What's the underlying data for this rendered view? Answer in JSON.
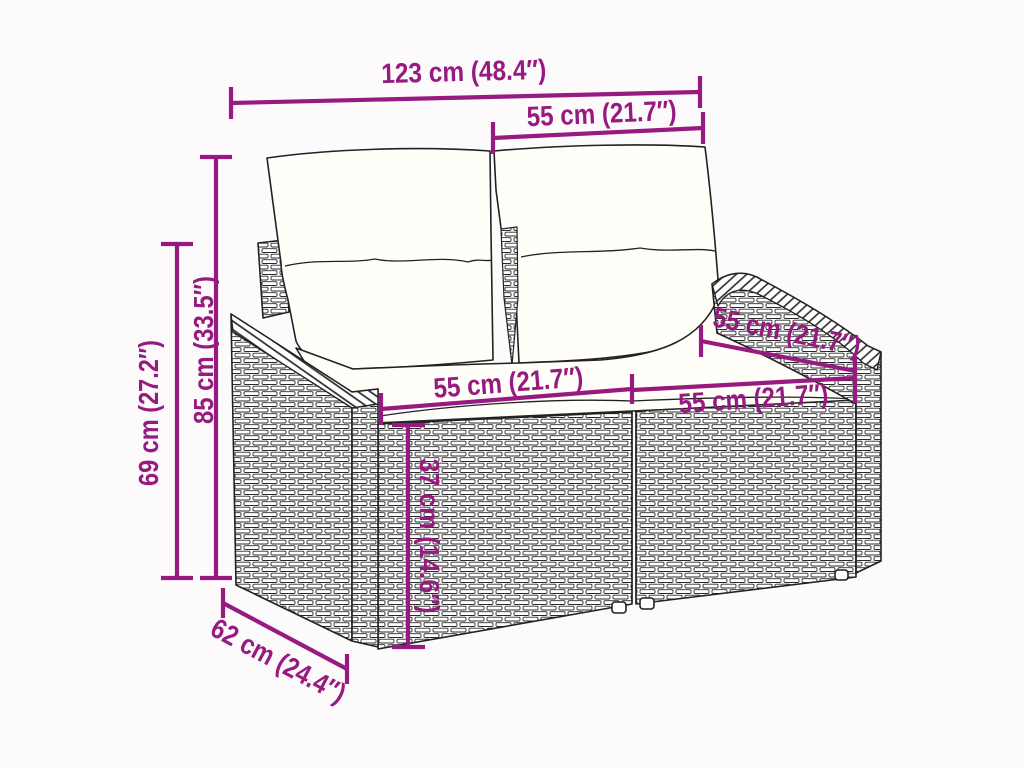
{
  "diagram": {
    "kind": "product-dimension-diagram",
    "subject": "poly-rattan 2-seater garden sofa with cushions, line drawing",
    "colors": {
      "accent": "#971A80",
      "ink": "#222222",
      "paper": "#FCFAFB",
      "cushion": "#FFFEF8"
    },
    "labels": {
      "total_width": "123 cm (48.4″)",
      "back_cushion_width": "55 cm (21.7″)",
      "total_height": "85 cm (33.5″)",
      "arm_height": "69 cm (27.2″)",
      "seat_width_left": "55 cm (21.7″)",
      "seat_depth_top": "55 cm (21.7″)",
      "seat_width_right": "55 cm (21.7″)",
      "seat_height": "37 cm (14.6″)",
      "base_depth": "62 cm (24.4″)"
    }
  }
}
